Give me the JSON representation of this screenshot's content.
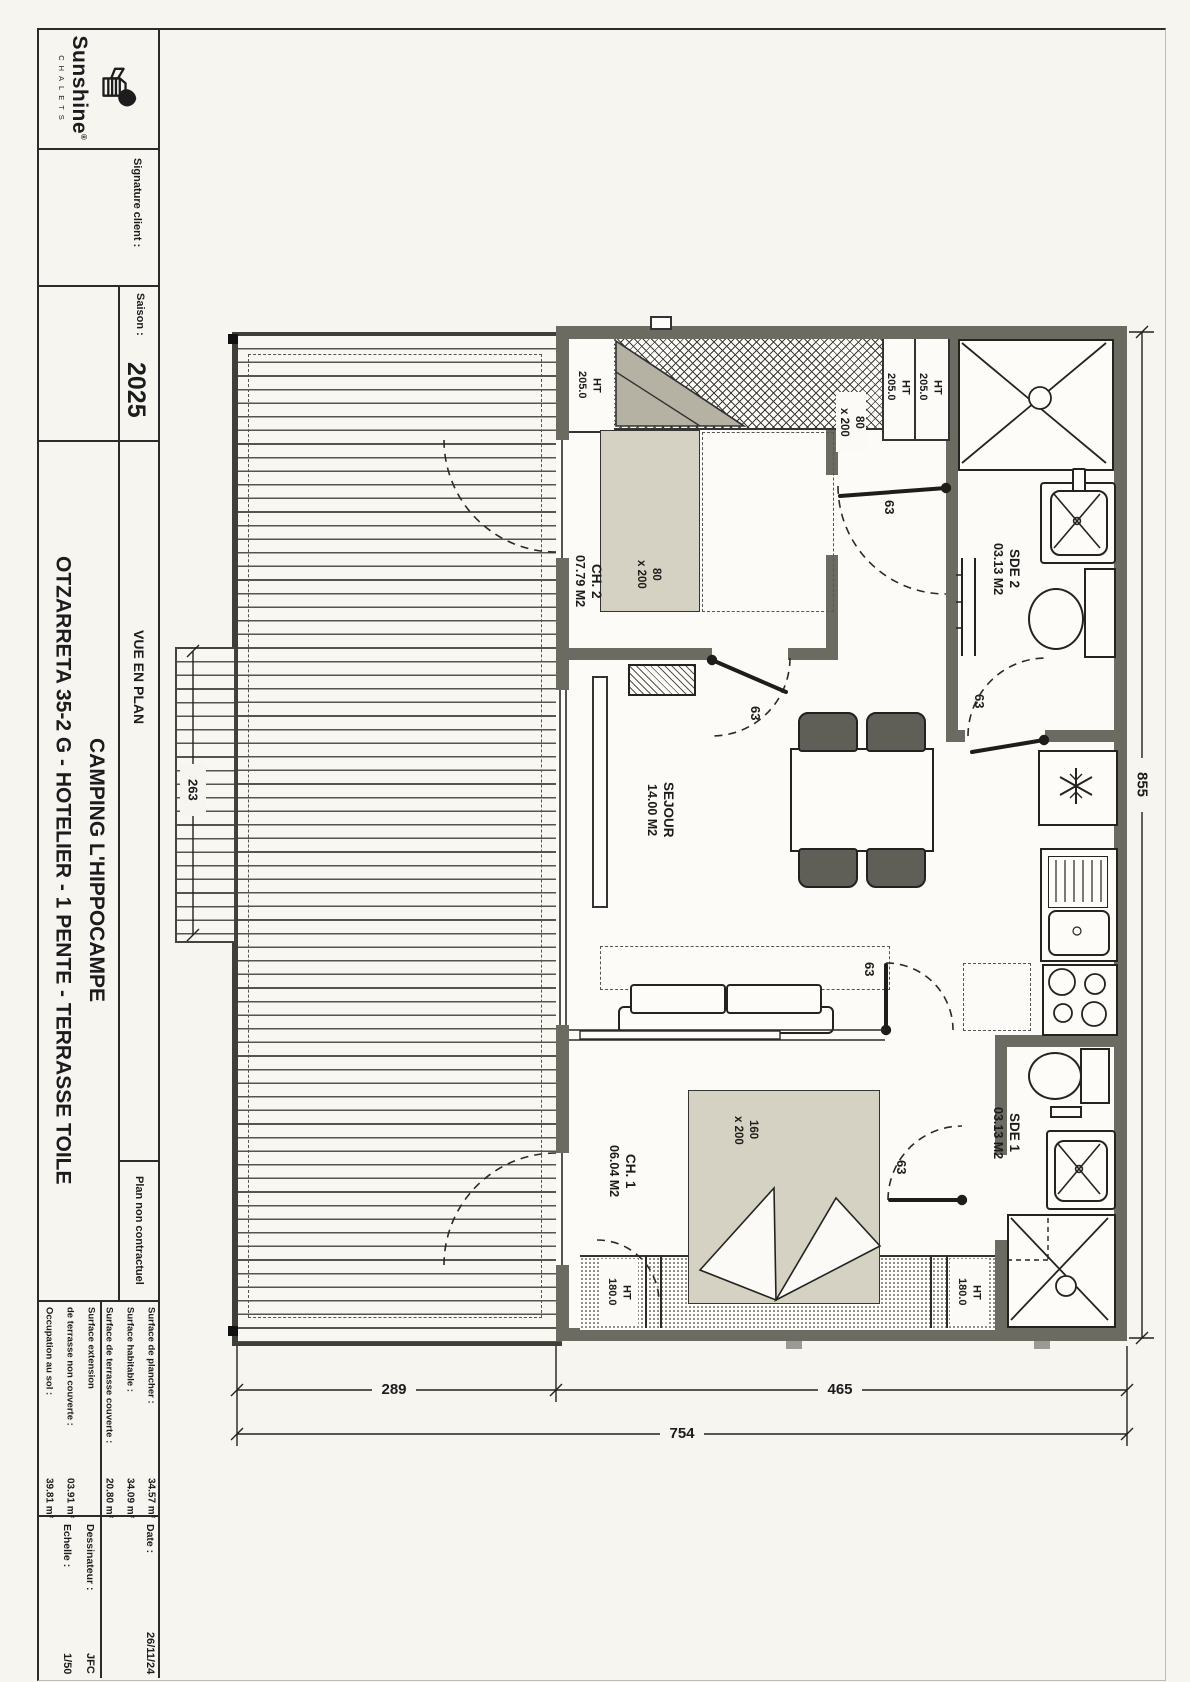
{
  "title_block": {
    "brand": {
      "name": "Sunshine",
      "registered": "®",
      "subtitle": "CHALETS"
    },
    "signature_label": "Signature client :",
    "season": {
      "label": "Saison :",
      "value": "2025"
    },
    "project_title": {
      "line1": "OTZARRETA 35-2 G - HOTELIER - 1 PENTE - TERRASSE TOILE",
      "line2": "CAMPING L'HIPPOCAMPE"
    },
    "view_label": "VUE EN PLAN",
    "disclaimer": "Plan non contractuel",
    "surfaces": [
      {
        "label": "Surface de plancher :",
        "value": "34.57 m²"
      },
      {
        "label": "Surface habitable :",
        "value": "34.09 m²"
      },
      {
        "label": "Surface de terrasse couverte :",
        "value": "20.80 m²"
      },
      {
        "label": "Surface extension",
        "value": ""
      },
      {
        "label": "de terrasse non couverte :",
        "value": "03.91 m²"
      },
      {
        "label": "Occupation au sol :",
        "value": "39.81 m²"
      }
    ],
    "meta": [
      {
        "label": "Date :",
        "value": "26/11/24"
      },
      {
        "label": "Dessinateur :",
        "value": "JFC"
      },
      {
        "label": "Echelle :",
        "value": "1/50"
      }
    ]
  },
  "plan": {
    "rooms": {
      "ch2": {
        "name": "CH. 2",
        "area": "07.79 M2"
      },
      "sde2": {
        "name": "SDE 2",
        "area": "03.13 M2"
      },
      "sejour": {
        "name": "SEJOUR",
        "area": "14.00 M2"
      },
      "ch1": {
        "name": "CH. 1",
        "area": "06.04 M2"
      },
      "sde1": {
        "name": "SDE 1",
        "area": "03.13 M2"
      }
    },
    "labels": {
      "ht205": "HT\n205.0",
      "ht180": "HT\n180.0",
      "bed_small": "80\nx 200",
      "bed_large": "160\nx 200",
      "door_width": "63"
    },
    "dimensions": {
      "terrace_width": "289",
      "chalet_width": "465",
      "total_width": "754",
      "chalet_depth": "855",
      "terrace_extension": "263"
    },
    "icons": {
      "fridge": "snowflake-icon",
      "shower": "shower-drain-icon",
      "washbasin": "washbasin-cross-icon",
      "wardrobe": "crosshatch-wardrobe"
    },
    "colors": {
      "wall": "#6b6b62",
      "bed_fill": "#d5d1c3",
      "paper": "#f6f5f0"
    }
  }
}
